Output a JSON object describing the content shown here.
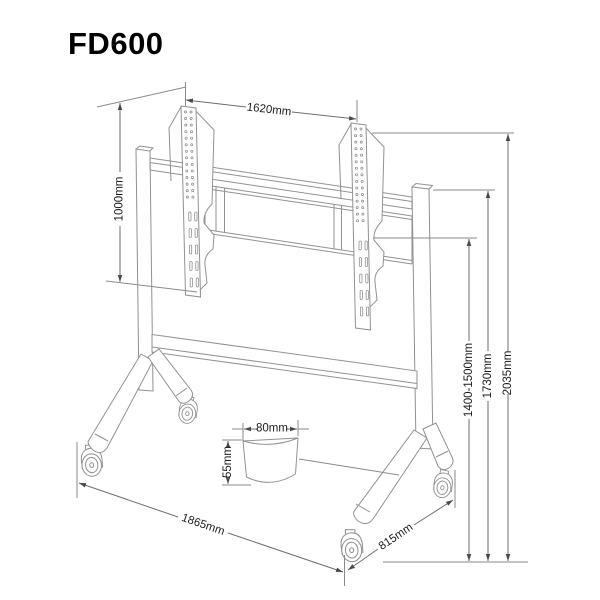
{
  "title": "FD600",
  "diagram": {
    "subject": "mobile TV floor stand dimension drawing",
    "dimensions": {
      "bracket_width": "1620mm",
      "bracket_height": "1000mm",
      "screen_height_range": "1400-1500mm",
      "post_height": "1730mm",
      "total_height": "2035mm",
      "cup_diameter": "80mm",
      "cup_height": "55mm",
      "base_length": "1865mm",
      "base_depth": "815mm"
    },
    "colors": {
      "background": "#ffffff",
      "structure_line": "#929292",
      "dimension_line": "#6e6e6e",
      "text": "#1c1c1c",
      "title": "#000000"
    }
  }
}
